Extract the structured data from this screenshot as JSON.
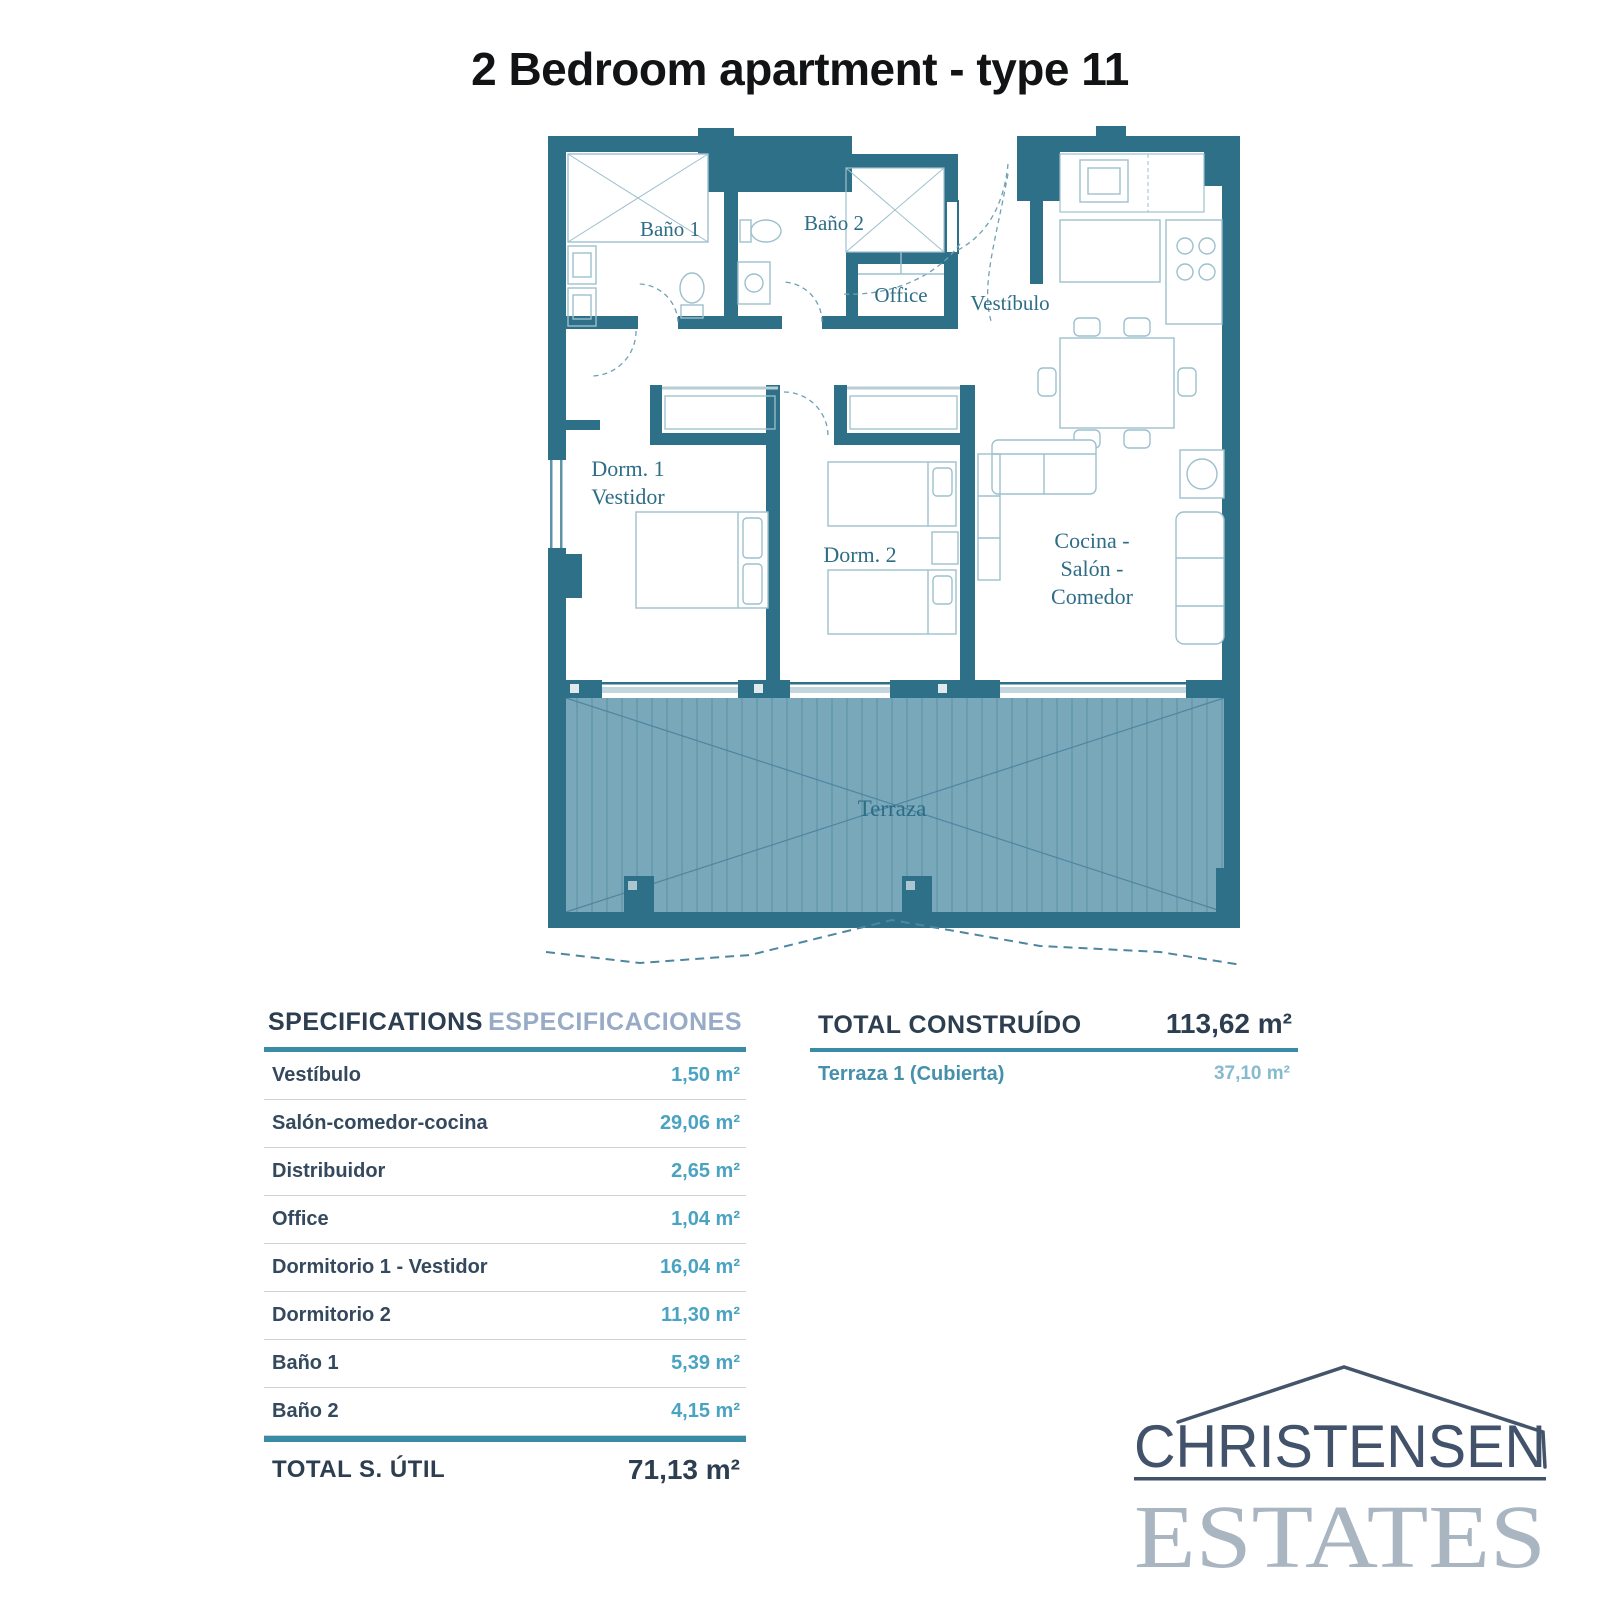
{
  "title": "2 Bedroom apartment - type 11",
  "plan": {
    "labels": {
      "bano1": "Baño 1",
      "bano2": "Baño 2",
      "office": "Office",
      "vestibulo": "Vestíbulo",
      "dorm1_line1": "Dorm. 1",
      "dorm1_line2": "Vestidor",
      "dorm2": "Dorm. 2",
      "cocina_line1": "Cocina -",
      "cocina_line2": "Salón -",
      "cocina_line3": "Comedor",
      "terraza": "Terraza"
    },
    "colors": {
      "wall": "#2f7089",
      "terrace_fill": "#79a8bb",
      "terrace_lines": "#5f93a8",
      "furniture_stroke": "#9cc0cd",
      "label_text": "#2e6d86"
    }
  },
  "specifications": {
    "header_en": "SPECIFICATIONS",
    "header_es": "ESPECIFICACIONES",
    "rows": [
      {
        "label": "Vestíbulo",
        "value": "1,50 m²"
      },
      {
        "label": "Salón-comedor-cocina",
        "value": "29,06 m²"
      },
      {
        "label": "Distribuidor",
        "value": "2,65 m²"
      },
      {
        "label": "Office",
        "value": "1,04 m²"
      },
      {
        "label": "Dormitorio 1 - Vestidor",
        "value": "16,04 m²"
      },
      {
        "label": "Dormitorio 2",
        "value": "11,30 m²"
      },
      {
        "label": "Baño 1",
        "value": "5,39 m²"
      },
      {
        "label": "Baño 2",
        "value": "4,15 m²"
      }
    ],
    "total_label": "TOTAL S. ÚTIL",
    "total_value": "71,13 m²"
  },
  "construido": {
    "header": "TOTAL CONSTRUÍDO",
    "header_value": "113,62 m²",
    "rows": [
      {
        "label": "Terraza 1 (Cubierta)",
        "value": "37,10 m²"
      }
    ]
  },
  "logo": {
    "name_top": "CHRISTENSEN",
    "name_bottom": "ESTATES"
  },
  "accent_colors": {
    "navy": "#2c3e50",
    "teal_rule": "#3a8ca6",
    "value_teal": "#4aa3c2",
    "header_es_blue": "#97abc6"
  }
}
